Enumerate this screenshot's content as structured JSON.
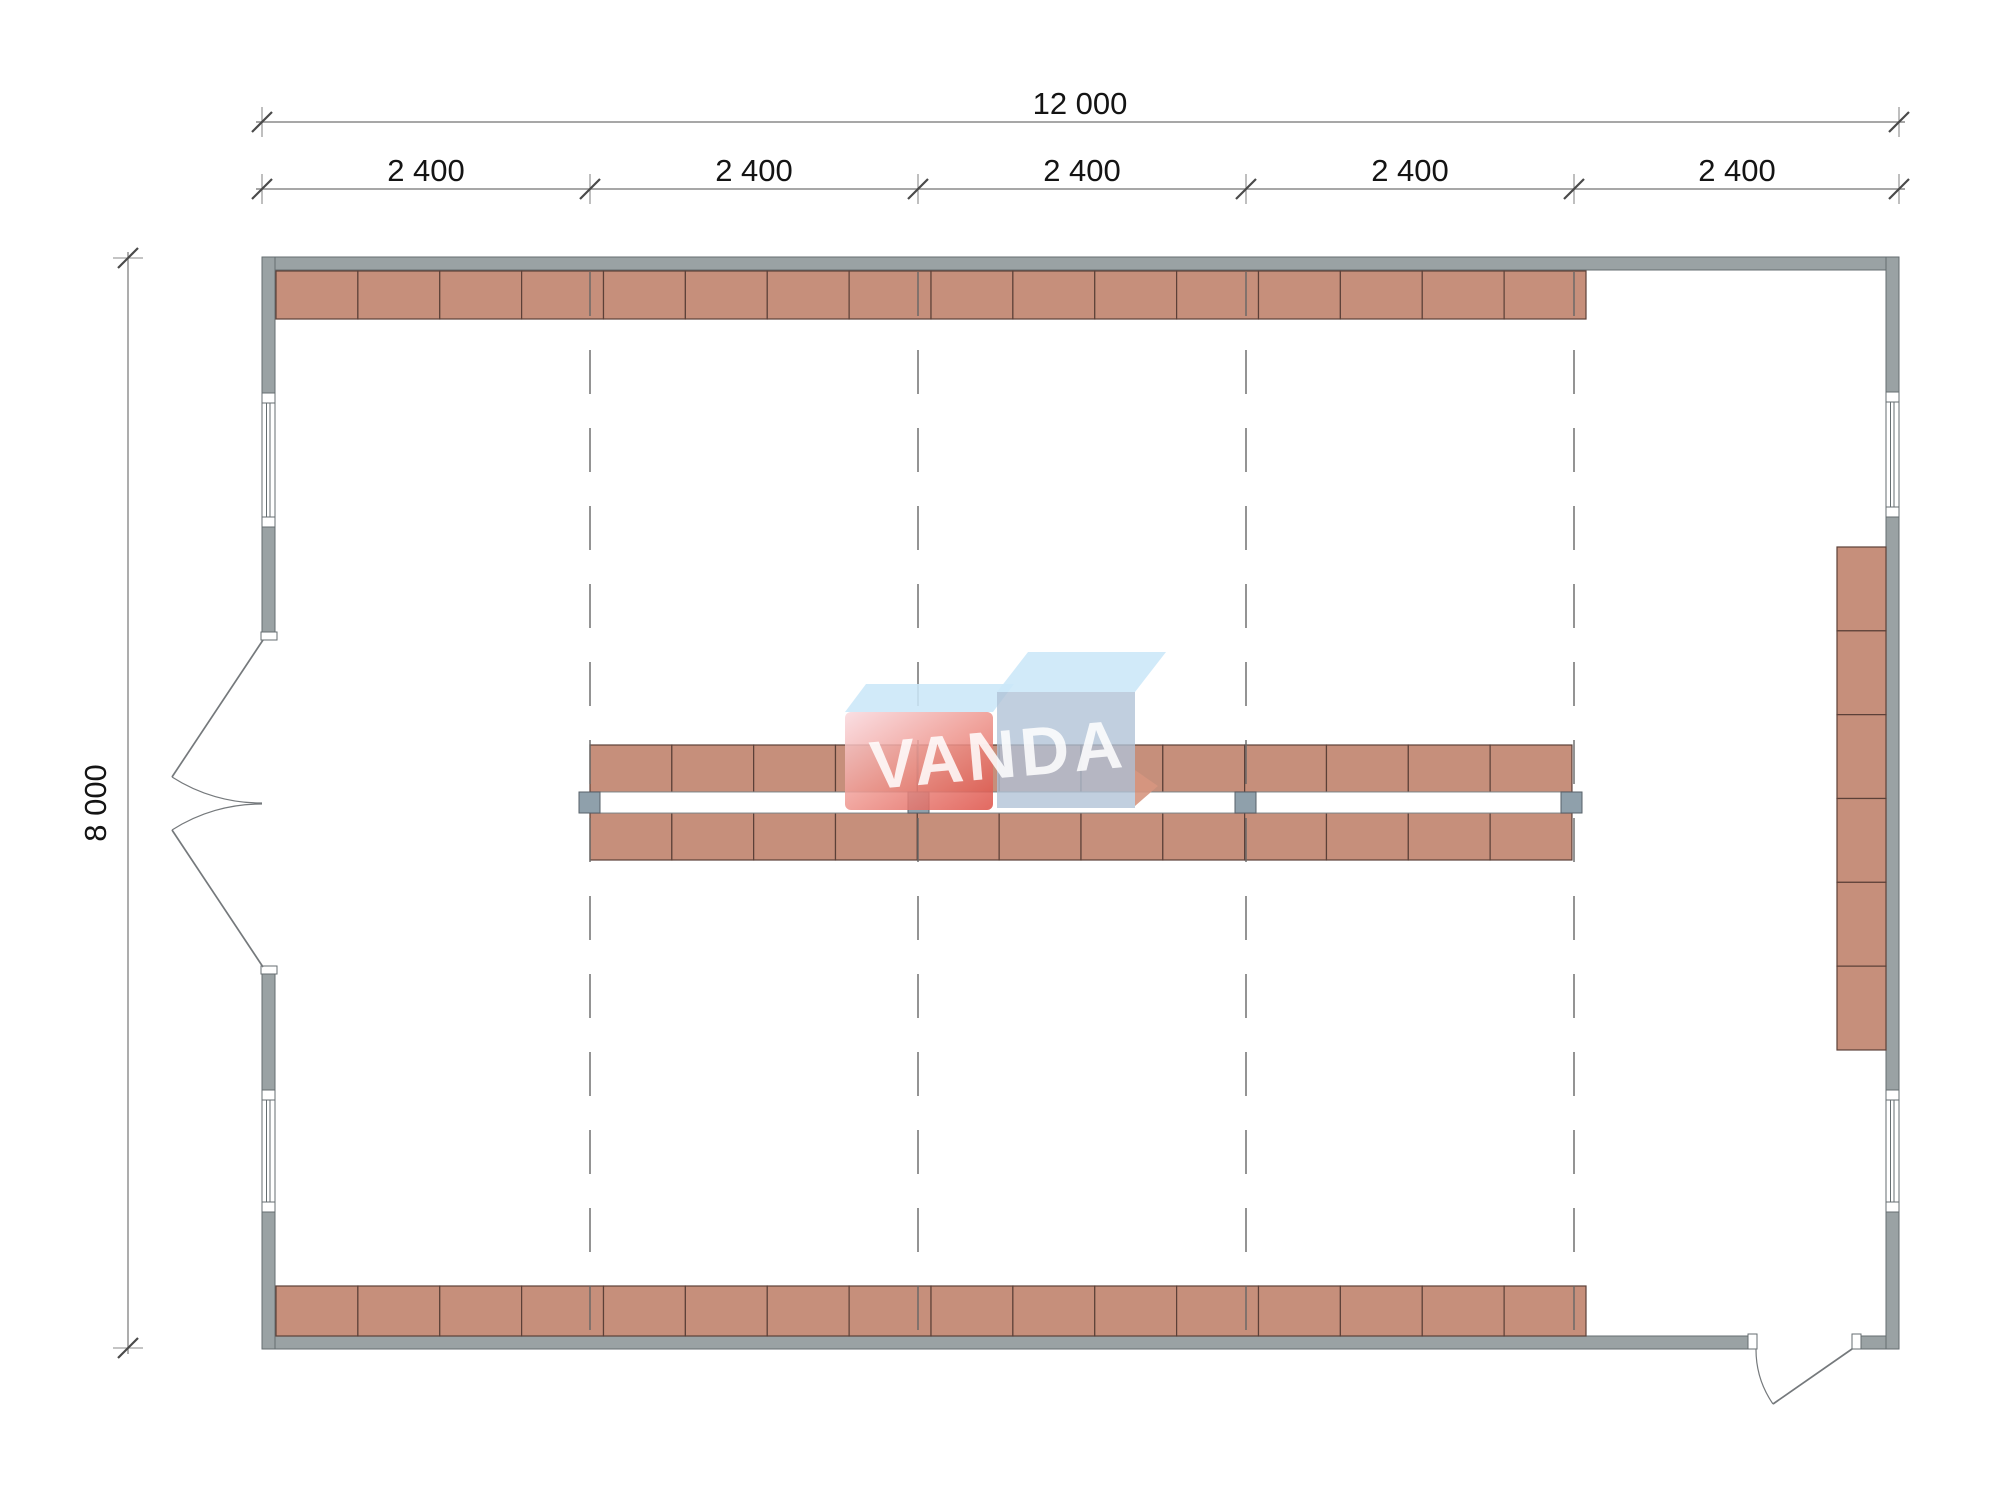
{
  "watermark": {
    "text": "VANDA"
  },
  "dimensions": {
    "top_total": {
      "label": "12 000"
    },
    "top_bays": [
      "2 400",
      "2 400",
      "2 400",
      "2 400",
      "2 400"
    ],
    "left_total": {
      "label": "8 000"
    }
  },
  "colors": {
    "wall": "#9aa2a4",
    "wallStroke": "#656e71",
    "shelfFill": "#c68f7b",
    "shelfStroke": "#5c4038",
    "aisleStroke": "#8a9093",
    "colFill": "#8fa0ab",
    "colStroke": "#57616a",
    "gridColor": "#666666",
    "dimLine": "#8a8a8a",
    "tickColor": "#4a4a4a",
    "textColor": "#141414",
    "doorLine": "#75797c",
    "logoBlueTop": "#cbe7f8",
    "logoBlueFace": "#b0c2d6",
    "logoPinkLight": "#f9d9de",
    "logoPinkDeep": "#dd4f45",
    "logoFold": "#d69680"
  },
  "plan": {
    "canvas": {
      "w": 2000,
      "h": 1488
    },
    "building": {
      "outer_x": 262,
      "outer_y": 257,
      "outer_w": 1637,
      "outer_h": 1092,
      "wall_thickness": 13,
      "bay_count": 5,
      "bay_module_label": "2 400",
      "width_label": "12 000",
      "depth_label": "8 000"
    },
    "walls": [
      [
        262,
        257,
        1637,
        13
      ],
      [
        262,
        1336,
        1486,
        13
      ],
      [
        1861,
        1336,
        38,
        13
      ],
      [
        262,
        257,
        13,
        136
      ],
      [
        262,
        527,
        13,
        106
      ],
      [
        262,
        973,
        13,
        117
      ],
      [
        262,
        1212,
        13,
        137
      ],
      [
        1886,
        257,
        13,
        135
      ],
      [
        1886,
        517,
        13,
        573
      ],
      [
        1886,
        1212,
        13,
        137
      ]
    ],
    "windows": [
      {
        "x": 262,
        "y": 393,
        "w": 13,
        "h": 134
      },
      {
        "x": 262,
        "y": 1090,
        "w": 13,
        "h": 122
      },
      {
        "x": 1886,
        "y": 392,
        "w": 13,
        "h": 125
      },
      {
        "x": 1886,
        "y": 1090,
        "w": 13,
        "h": 122
      }
    ],
    "jambs": [
      [
        261,
        632,
        16,
        8
      ],
      [
        261,
        966,
        16,
        8
      ],
      [
        1748,
        1334,
        9,
        15
      ],
      [
        1852,
        1334,
        9,
        15
      ]
    ],
    "door_leaves": [
      [
        263,
        640,
        172,
        777
      ],
      [
        263,
        967,
        172,
        830
      ],
      [
        1852,
        1349,
        1773,
        1404
      ]
    ],
    "door_arcs": [
      "M 172 777 A 164 164 0 0 0 262 803",
      "M 172 830 A 164 164 0 0 1 262 804",
      "M 1756 1349 A 96 96 0 0 0 1773 1404"
    ],
    "shelf_rows": [
      {
        "x": 276,
        "y": 271,
        "cells": 16,
        "cw": 81.875,
        "ch": 48,
        "dir": "h"
      },
      {
        "x": 276,
        "y": 1286,
        "cells": 16,
        "cw": 81.875,
        "ch": 50,
        "dir": "h"
      },
      {
        "x": 590,
        "y": 745,
        "cells": 12,
        "cw": 81.83,
        "ch": 47,
        "dir": "h"
      },
      {
        "x": 590,
        "y": 813,
        "cells": 12,
        "cw": 81.83,
        "ch": 47,
        "dir": "h"
      },
      {
        "x": 1837,
        "y": 547,
        "cells": 6,
        "cw": 49,
        "ch": 83.83,
        "dir": "v"
      }
    ],
    "aisle": {
      "x": 590,
      "y": 792,
      "w": 982,
      "h": 21
    },
    "columns": {
      "size": 21,
      "pos": [
        [
          579,
          792
        ],
        [
          908,
          792
        ],
        [
          1235,
          792
        ],
        [
          1561,
          792
        ]
      ]
    },
    "grid": {
      "xs": [
        590,
        918,
        1246,
        1574
      ],
      "y1": 272,
      "y2": 1336
    },
    "dims": {
      "row1": {
        "y": 122,
        "x1": 262,
        "x2": 1899,
        "ticks": [
          262,
          1899
        ]
      },
      "row2": {
        "y": 189,
        "x1": 262,
        "x2": 1899,
        "ticks": [
          262,
          590,
          918,
          1246,
          1574,
          1899
        ]
      },
      "col": {
        "x": 128,
        "y1": 258,
        "y2": 1348,
        "ticks": [
          258,
          1348
        ]
      }
    }
  }
}
